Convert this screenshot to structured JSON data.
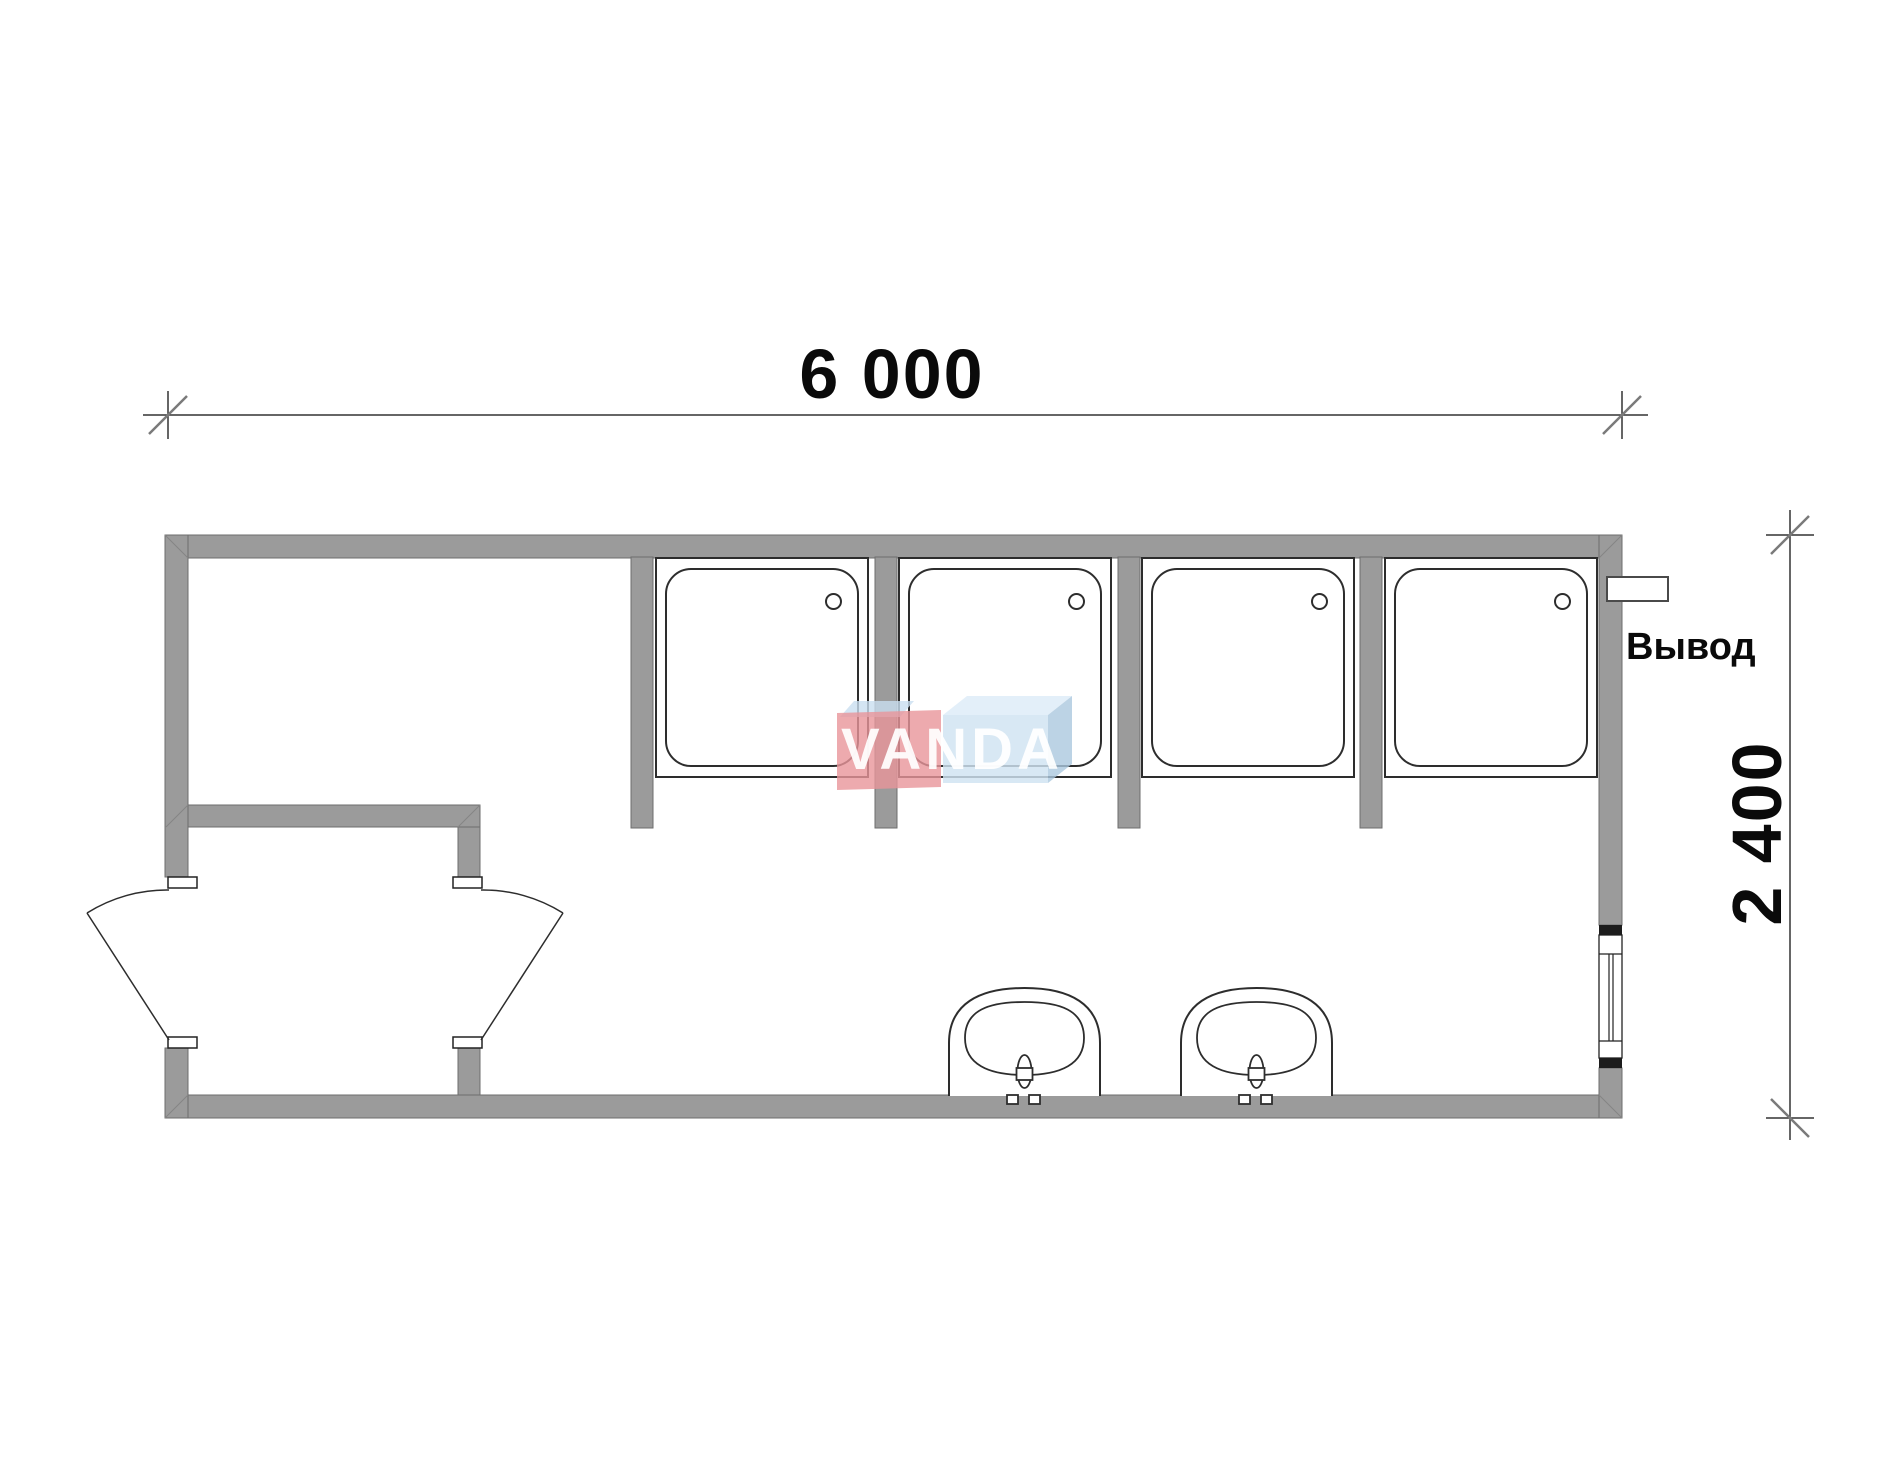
{
  "drawing": {
    "kind": "modular-cabin-floor-plan",
    "dimensions": {
      "width_label": "6 000",
      "height_label": "2 400"
    },
    "labels": {
      "outlet": "Вывод"
    },
    "watermark": {
      "text": "VANDA",
      "pink_face_color": "#e8959a",
      "blue_face_color": "#cfe3f2",
      "blue_top_color": "#dcebf7",
      "blue_side_color": "#abc8df",
      "text_color": "#ffffff"
    },
    "colors": {
      "wall_fill": "#9b9b9b",
      "wall_edge": "#6e6e6e",
      "fixture_line": "#2d2d2d",
      "dimension_line": "#333333",
      "tick_slash": "#7a7a7a",
      "window_cap": "#1c1c1c"
    },
    "fixtures": {
      "shower_stalls": 4,
      "washbasins": 2,
      "swing_doors": 2,
      "windows": 1,
      "outlets": 1
    }
  }
}
